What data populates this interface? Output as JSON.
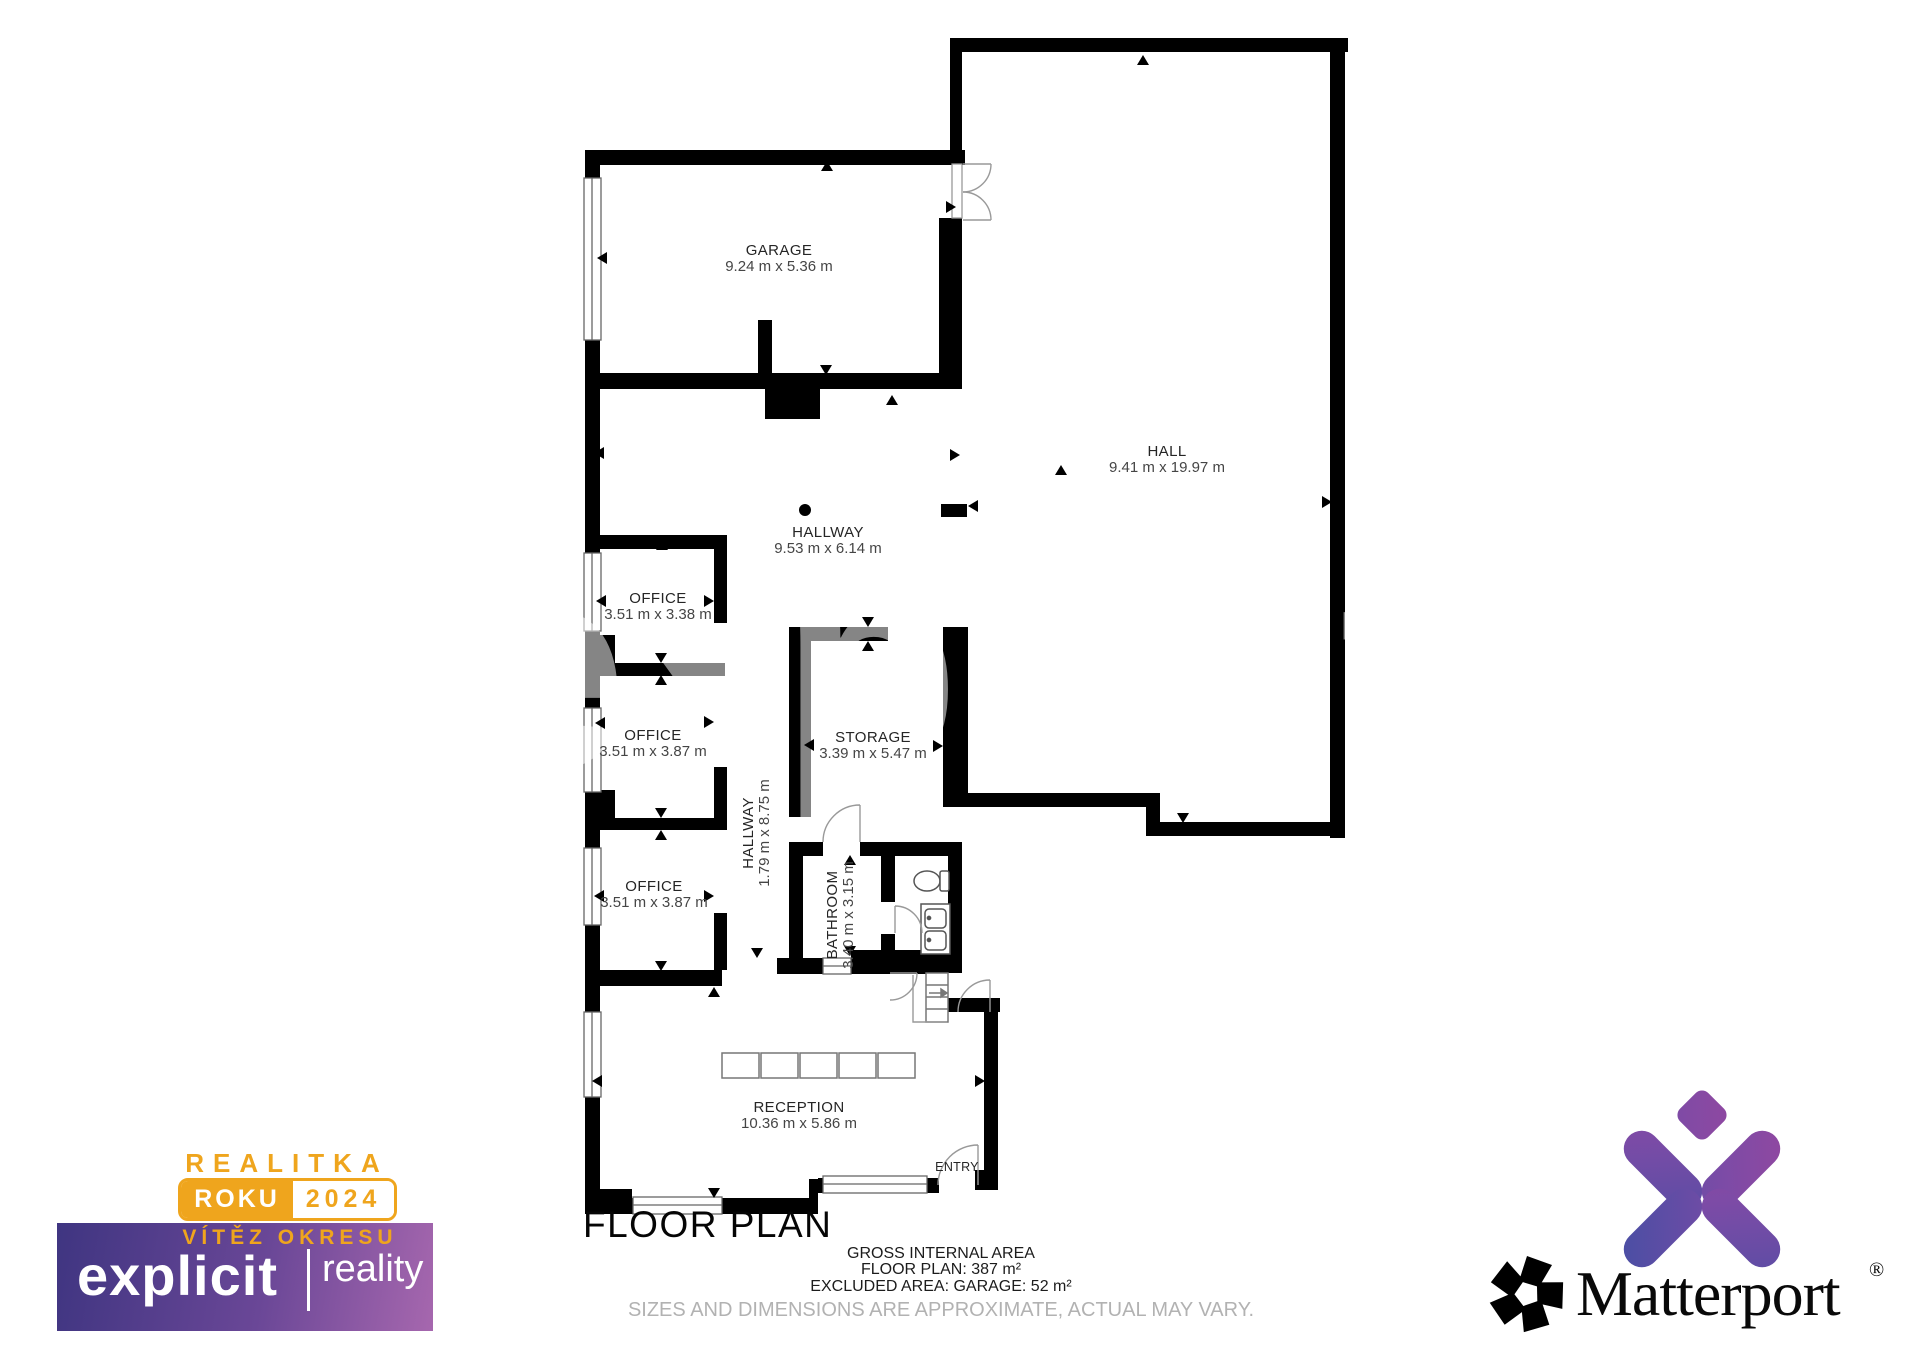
{
  "title": "FLOOR PLAN",
  "rooms": [
    {
      "name": "GARAGE",
      "dims": "9.24 m x 5.36 m"
    },
    {
      "name": "HALL",
      "dims": "9.41 m x 19.97 m"
    },
    {
      "name": "HALLWAY",
      "dims": "9.53 m x 6.14 m"
    },
    {
      "name": "OFFICE",
      "dims": "3.51 m x 3.38 m"
    },
    {
      "name": "OFFICE",
      "dims": "3.51 m x 3.87 m"
    },
    {
      "name": "OFFICE",
      "dims": "3.51 m x 3.87 m"
    },
    {
      "name": "HALLWAY",
      "dims": "1.79 m x 8.75 m"
    },
    {
      "name": "STORAGE",
      "dims": "3.39 m x 5.47 m"
    },
    {
      "name": "BATHROOM",
      "dims": "3.40 m x 3.15 m"
    },
    {
      "name": "RECEPTION",
      "dims": "10.36 m x 5.86 m"
    },
    {
      "name": "ENTRY"
    }
  ],
  "footer": {
    "line1": "GROSS INTERNAL AREA",
    "line2": "FLOOR PLAN: 387 m²",
    "line3": "EXCLUDED AREA: GARAGE: 52 m²",
    "disclaimer": "SIZES AND DIMENSIONS ARE APPROXIMATE, ACTUAL MAY VARY."
  },
  "award_badge": {
    "title": "REALITKA",
    "roku": "ROKU",
    "year": "2024",
    "subtitle": "VÍTĚZ OKRESU",
    "brand": "explicit",
    "brand_secondary": "reality",
    "gold": "#EFA51D",
    "purple_from": "#3F3581",
    "purple_to": "#A667AE"
  },
  "matterport": {
    "wordmark": "Matterport",
    "registered": "®",
    "icon": "matterport-x-icon",
    "mark_icon": "matterport-aperture-icon",
    "gradient_from": "#4B4EA4",
    "gradient_to": "#9B469D"
  },
  "watermark": "explicit"
}
